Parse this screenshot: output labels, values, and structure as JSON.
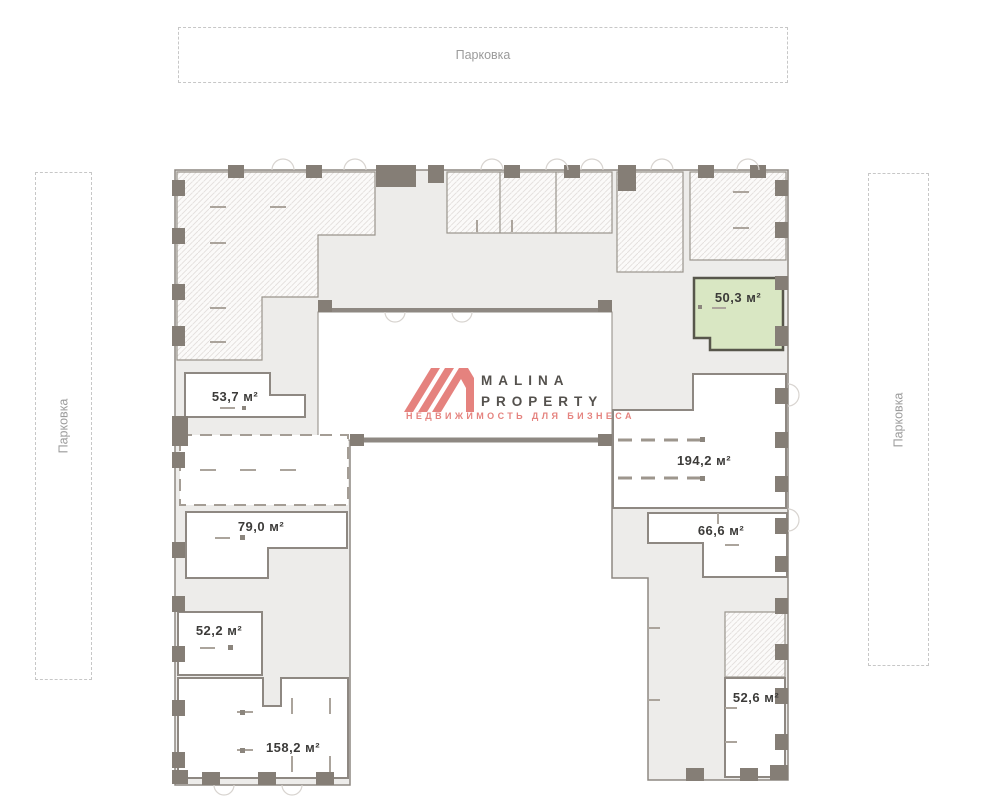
{
  "brand": {
    "name_line1": "MALINA",
    "name_line2": "PROPERTY",
    "tagline": "НЕДВИЖИМОСТЬ ДЛЯ БИЗНЕСА",
    "accent_color": "#e5837f"
  },
  "parking": {
    "top_label": "Парковка",
    "left_label": "Парковка",
    "right_label": "Парковка"
  },
  "plan": {
    "units": [
      {
        "id": "53-7",
        "label": "53,7 м²",
        "status": "available"
      },
      {
        "id": "79-0",
        "label": "79,0 м²",
        "status": "available"
      },
      {
        "id": "52-2",
        "label": "52,2 м²",
        "status": "available"
      },
      {
        "id": "158-2",
        "label": "158,2 м²",
        "status": "available"
      },
      {
        "id": "194-2",
        "label": "194,2 м²",
        "status": "available"
      },
      {
        "id": "66-6",
        "label": "66,6 м²",
        "status": "available"
      },
      {
        "id": "52-6",
        "label": "52,6 м²",
        "status": "available"
      },
      {
        "id": "50-3",
        "label": "50,3 м²",
        "status": "highlighted"
      }
    ],
    "colors": {
      "wall": "#8e8882",
      "base_fill": "#edecea",
      "hatch_line": "#e2dfdc",
      "highlight_fill": "#d9e7c3",
      "highlight_stroke": "#57564b",
      "label_text": "#3c3b39"
    }
  }
}
